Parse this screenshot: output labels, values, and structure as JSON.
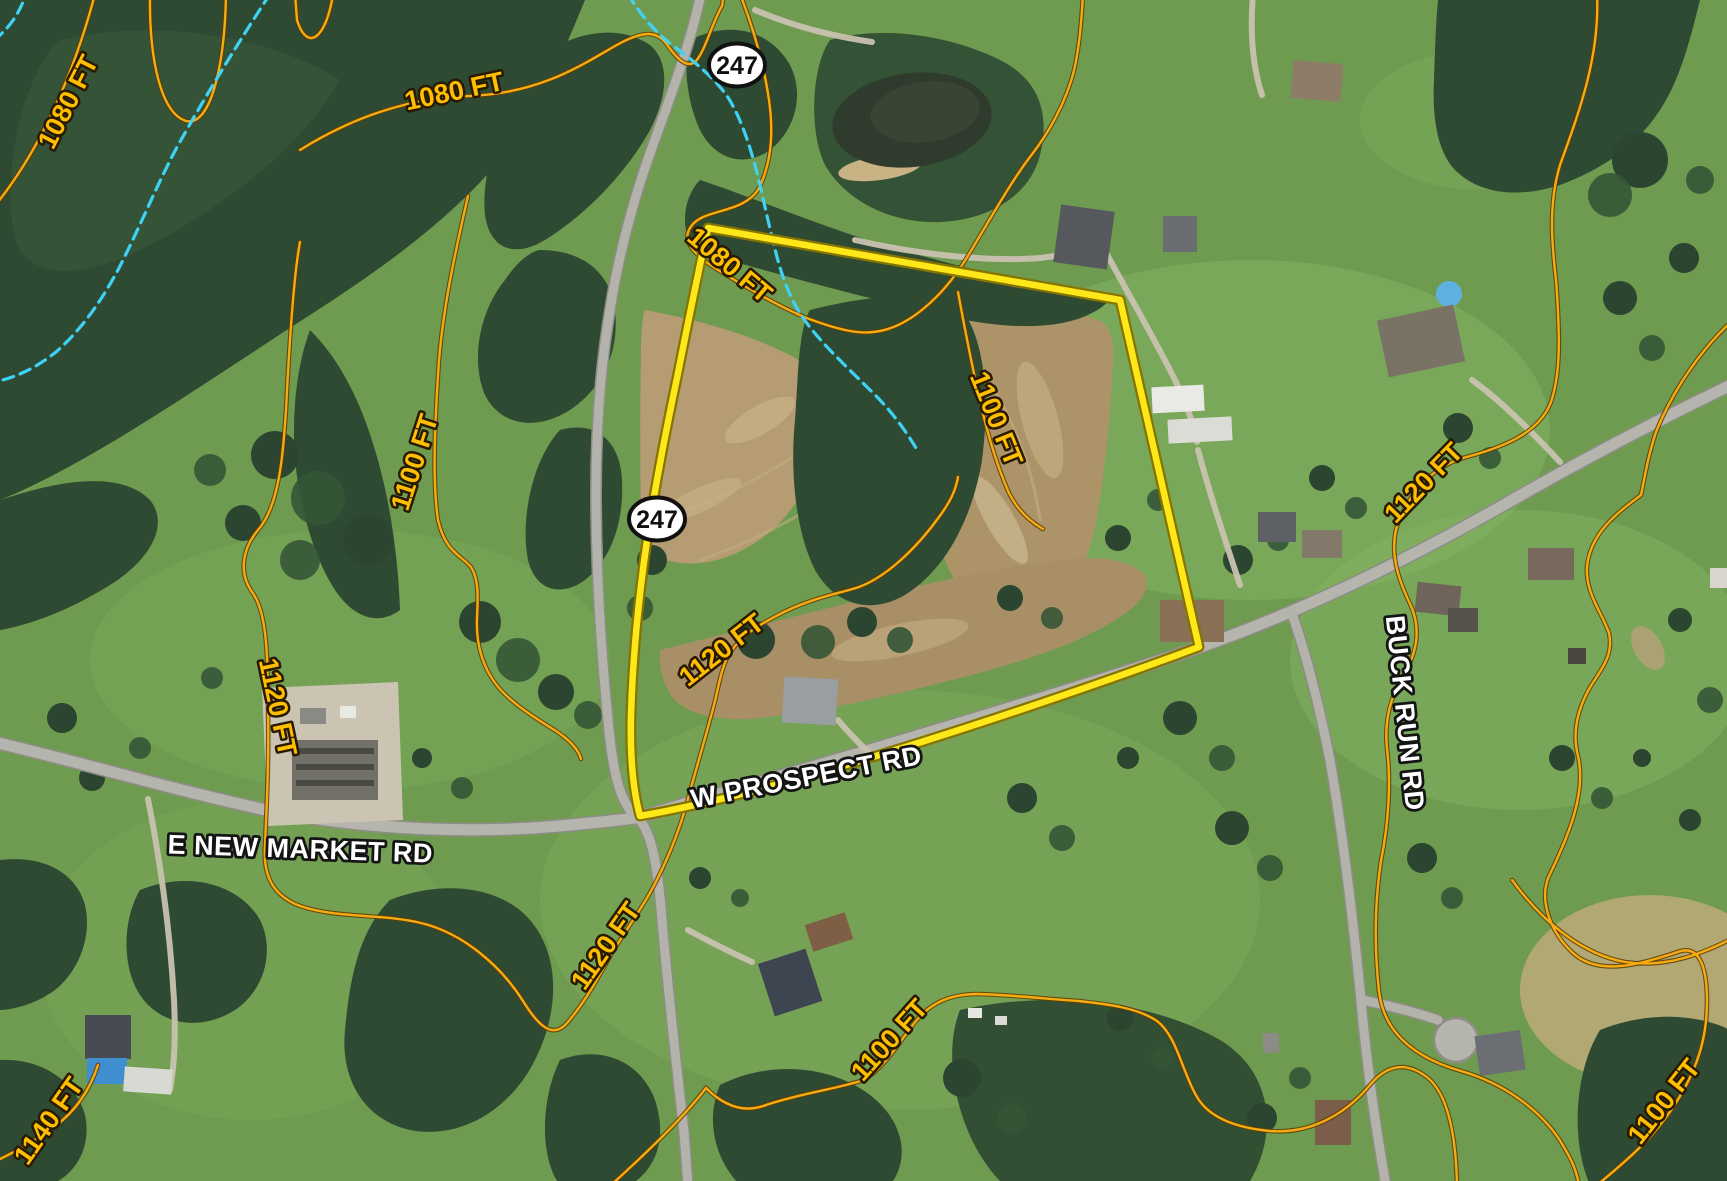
{
  "map": {
    "type": "aerial-parcel-map",
    "parcel_boundary": {
      "color": "#ffe600",
      "description": "highlighted property boundary polygon"
    },
    "route_shields": [
      {
        "number": "247"
      },
      {
        "number": "247"
      }
    ],
    "road_labels": [
      {
        "text": "E NEW MARKET RD"
      },
      {
        "text": "W PROSPECT RD"
      },
      {
        "text": "BUCK RUN RD"
      }
    ],
    "contour_labels": [
      {
        "text": "1080 FT"
      },
      {
        "text": "1080 FT"
      },
      {
        "text": "1080 FT"
      },
      {
        "text": "1100 FT"
      },
      {
        "text": "1100 FT"
      },
      {
        "text": "1120 FT"
      },
      {
        "text": "1120 FT"
      },
      {
        "text": "1120 FT"
      },
      {
        "text": "1120 FT"
      },
      {
        "text": "1140 FT"
      },
      {
        "text": "1100 FT"
      },
      {
        "text": "1100 FT"
      }
    ],
    "colors": {
      "contour_line": "#f2a81e",
      "contour_label": "#ffbe00",
      "stream": "#3fd2f5",
      "parcel_boundary": "#ffe600",
      "road_label": "#ffffff",
      "shield_text": "#101010",
      "field_green": "#6f9b50",
      "forest_green": "#2e4a32",
      "dirt_tan": "#b19a6f"
    }
  }
}
